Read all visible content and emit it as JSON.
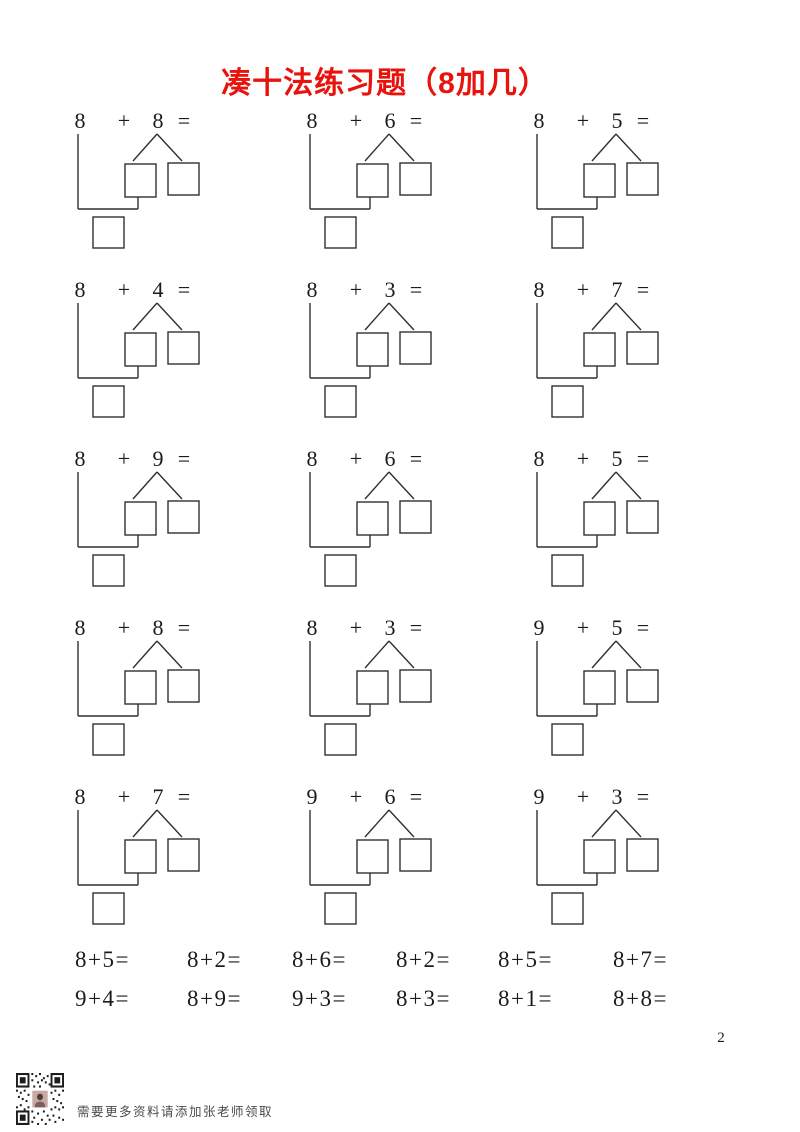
{
  "title": "凑十法练习题（8加几）",
  "symbols": {
    "plus": "+",
    "equals": "="
  },
  "problems": [
    {
      "a": "8",
      "b": "8"
    },
    {
      "a": "8",
      "b": "6"
    },
    {
      "a": "8",
      "b": "5"
    },
    {
      "a": "8",
      "b": "4"
    },
    {
      "a": "8",
      "b": "3"
    },
    {
      "a": "8",
      "b": "7"
    },
    {
      "a": "8",
      "b": "9"
    },
    {
      "a": "8",
      "b": "6"
    },
    {
      "a": "8",
      "b": "5"
    },
    {
      "a": "8",
      "b": "8"
    },
    {
      "a": "8",
      "b": "3"
    },
    {
      "a": "9",
      "b": "5"
    },
    {
      "a": "8",
      "b": "7"
    },
    {
      "a": "9",
      "b": "6"
    },
    {
      "a": "9",
      "b": "3"
    }
  ],
  "quick_practice": {
    "rows": [
      [
        "8+5=",
        "8+2=",
        "8+6=",
        "8+2=",
        "8+5=",
        "8+7="
      ],
      [
        "9+4=",
        "8+9=",
        "9+3=",
        "8+3=",
        "8+1=",
        "8+8="
      ]
    ]
  },
  "footer": {
    "note": "需要更多资料请添加张老师领取"
  },
  "page_number": "2",
  "colors": {
    "title_red": "#e8130d",
    "line": "#303030"
  }
}
